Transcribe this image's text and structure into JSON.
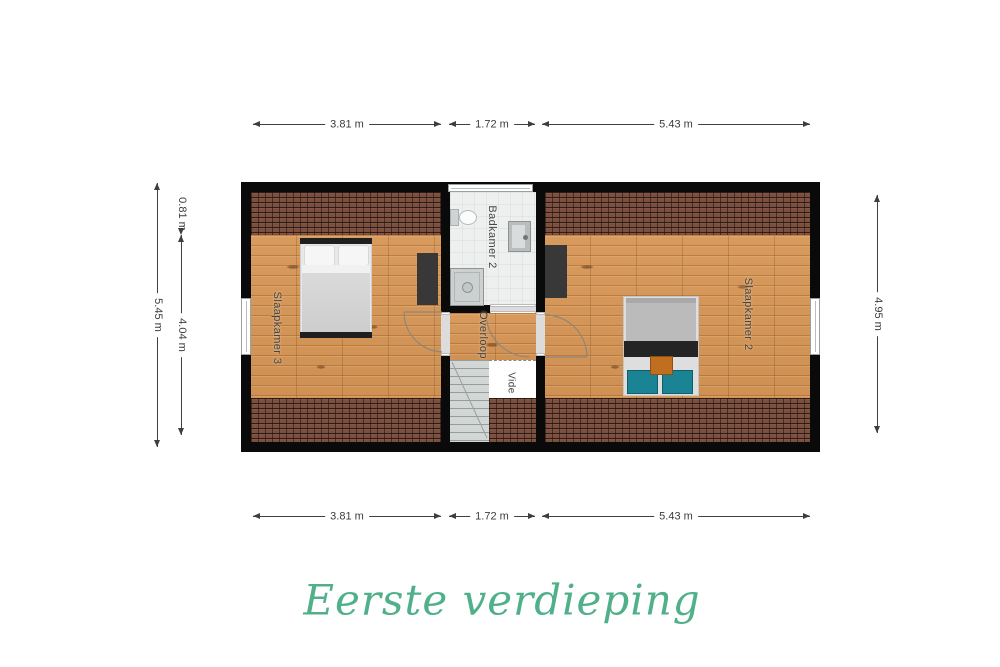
{
  "title": "Eerste verdieping",
  "rooms": {
    "bedroom3": "Slaapkamer 3",
    "bathroom": "Badkamer 2",
    "landing": "Overloop",
    "void": "Vide",
    "bedroom2": "Slaapkamer 2"
  },
  "dimensions": {
    "top": [
      "3.81 m",
      "1.72 m",
      "5.43 m"
    ],
    "bottom": [
      "3.81 m",
      "1.72 m",
      "5.43 m"
    ],
    "left_total": "5.45 m",
    "left_segments": [
      "0.81 m",
      "4.04 m"
    ],
    "right": "4.95 m"
  },
  "colors": {
    "wall": "#0a0a0a",
    "wood_floor": "#d6985b",
    "roof_tile": "#7b5040",
    "bath_floor": "#eef0ef",
    "title_accent": "#4fb08a",
    "pillow_teal": "#1b8494",
    "cushion_orange": "#bf6f1f"
  }
}
